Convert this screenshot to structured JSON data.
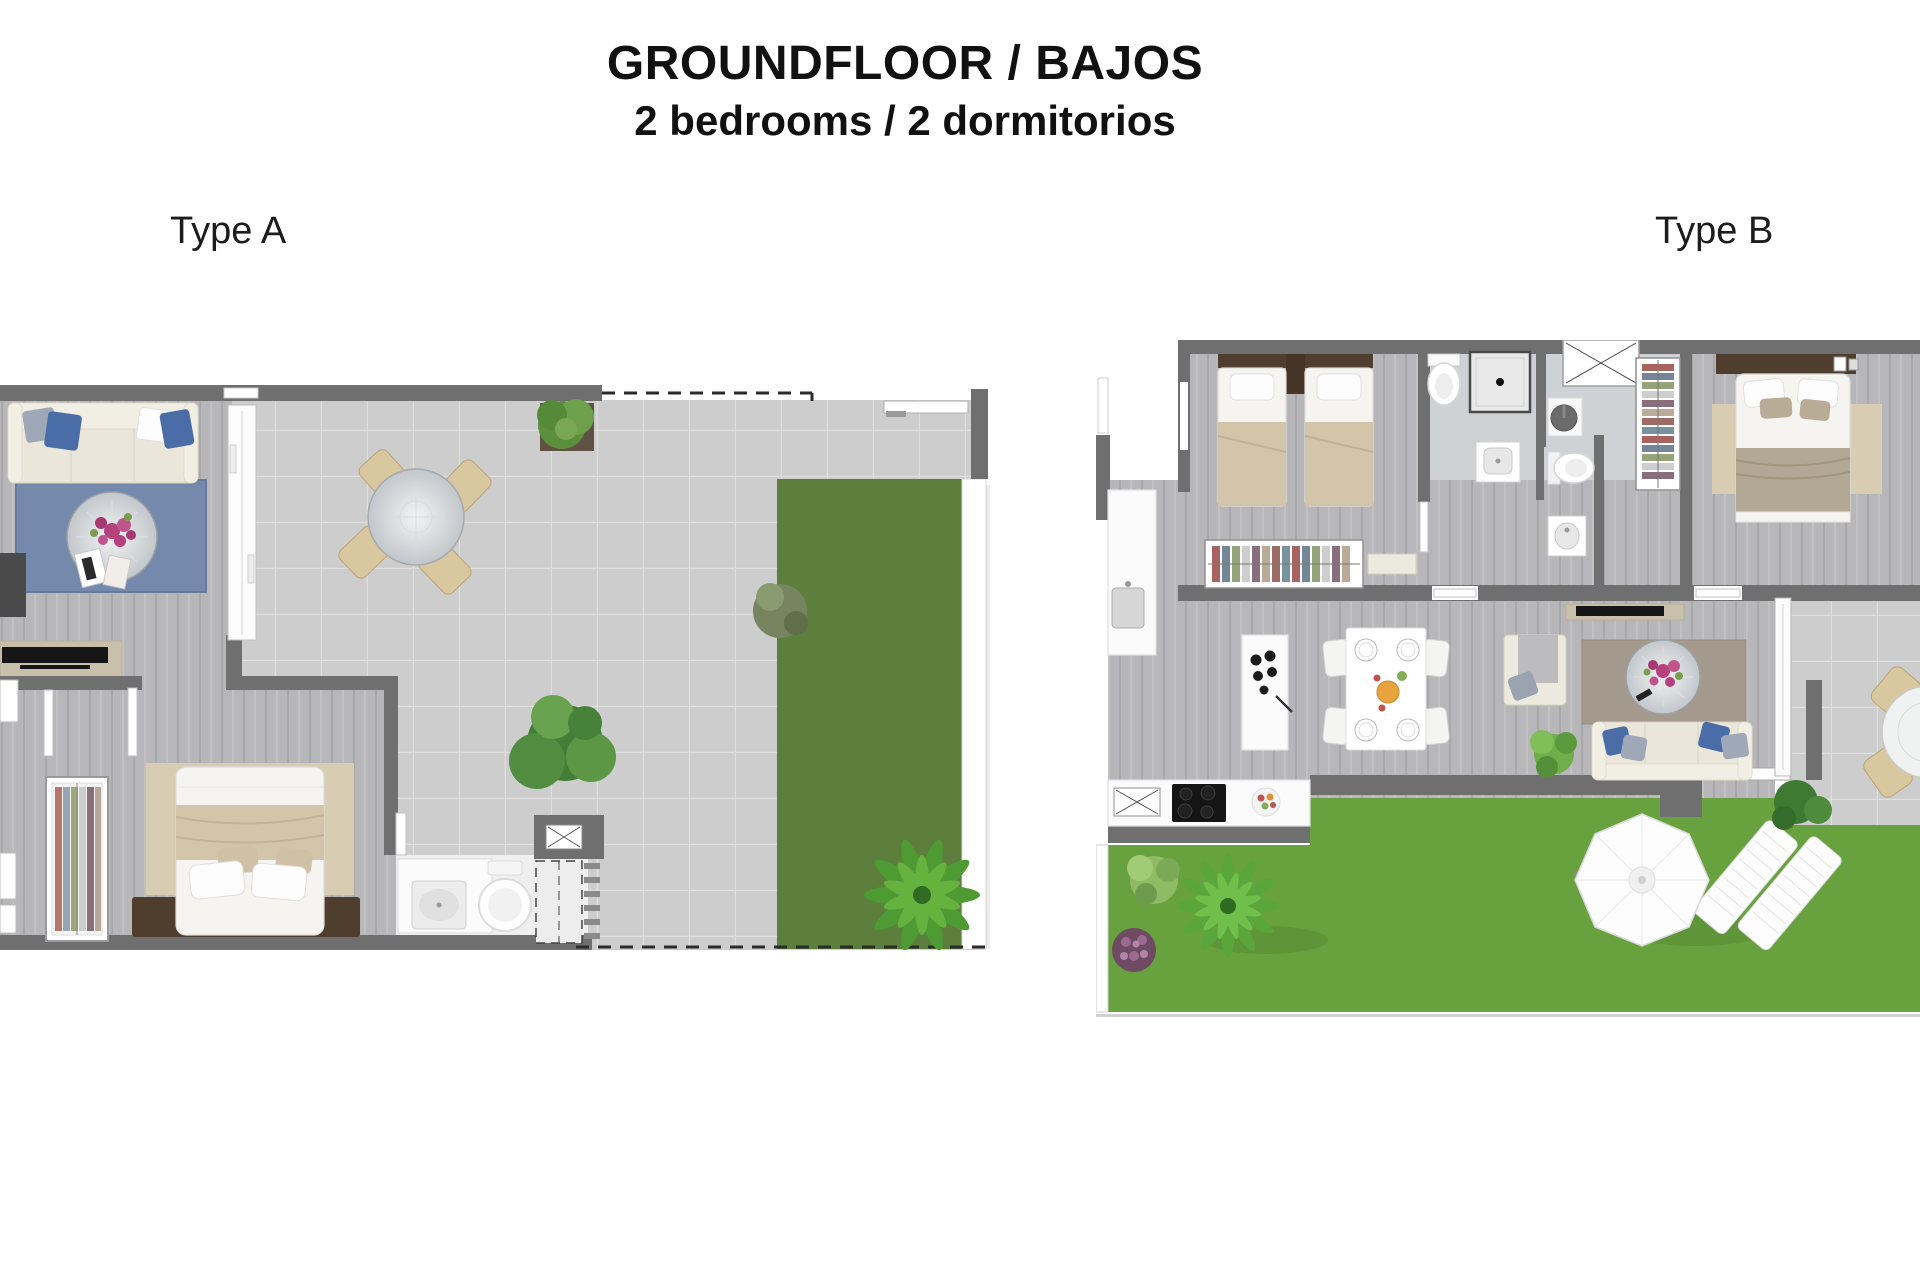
{
  "header": {
    "title": "GROUNDFLOOR / BAJOS",
    "subtitle": "2 bedrooms / 2 dormitorios"
  },
  "plans": [
    {
      "id": "type-a",
      "label": "Type A",
      "features": [
        "living-room-sofa",
        "blue-rug",
        "round-coffee-table",
        "tv-console",
        "terrace-dining-table-4-chairs",
        "potted-grass-plant",
        "lawn-strip",
        "double-bed",
        "wardrobe",
        "washbasin",
        "toilet",
        "shower",
        "garden-tree",
        "palm-plant",
        "dashed-property-line"
      ]
    },
    {
      "id": "type-b",
      "label": "Type B",
      "features": [
        "twin-bedroom-two-beds",
        "wardrobes",
        "desk",
        "bathroom-shower",
        "bathroom-toilets-washbasins",
        "master-double-bed",
        "tv-console",
        "kitchen-counter-island-hob",
        "dining-table-4-chairs",
        "armchair",
        "sofa",
        "round-coffee-table",
        "garden-lawn",
        "parasol",
        "sun-loungers",
        "fern-plant",
        "terrace-round-table"
      ]
    }
  ],
  "colors": {
    "wall": "#6f6f6f",
    "tile": "#cdcdce",
    "tileLine": "#dedede",
    "wood": "#b7b7b9",
    "grassA": "#5d7f3e",
    "grassB": "#67a23e",
    "rugBlue": "#7589ad",
    "rugBeige": "#d8cdb2",
    "rugTaupe": "#a39a8d",
    "sofa": "#eae6d9",
    "pillowBlue": "#4a6da8",
    "blanketBeige": "#d3c5a9",
    "blanketTaupe": "#b3a894",
    "headboard": "#4f3d2d",
    "console": "#c9c0ab",
    "tv": "#161616",
    "flowerPink": "#b5417d"
  }
}
